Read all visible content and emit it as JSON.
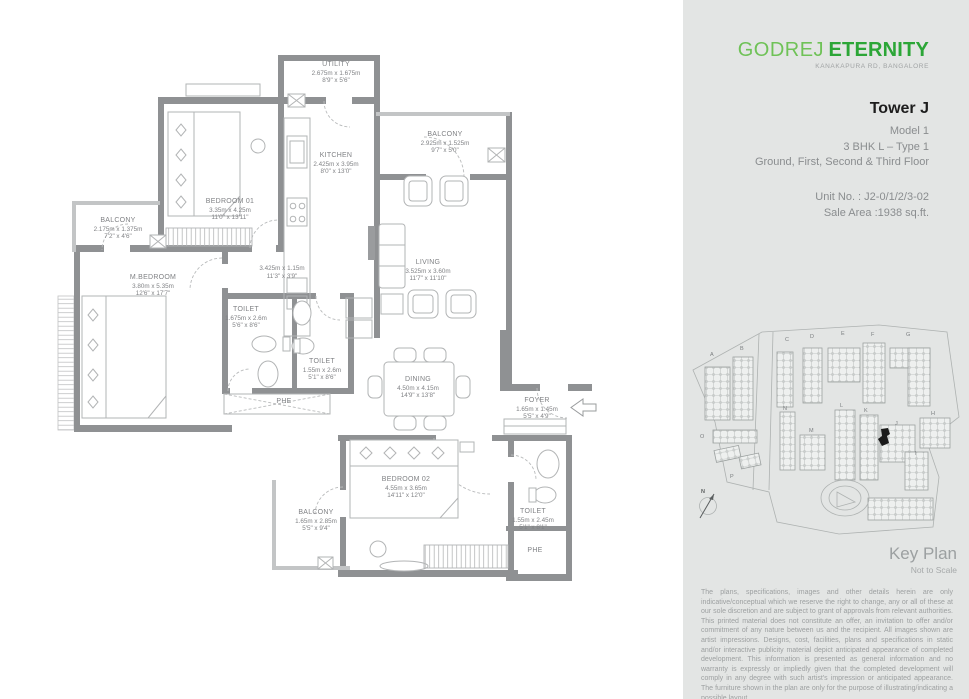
{
  "panel": {
    "brand": {
      "name_light": "GODREJ",
      "name_bold": "ETERNITY",
      "subtitle": "KANAKAPURA RD, BANGALORE"
    },
    "tower_title": "Tower J",
    "model_lines": [
      "Model 1",
      "3 BHK L – Type 1",
      "Ground, First, Second & Third Floor"
    ],
    "unit_no": "Unit No. : J2-0/1/2/3-02",
    "sale_area": "Sale Area :1938 sq.ft.",
    "key_plan": {
      "title": "Key Plan",
      "subtitle": "Not to Scale",
      "highlight_tower": "J",
      "towers": [
        "A",
        "B",
        "C",
        "D",
        "E",
        "F",
        "G",
        "N",
        "M",
        "L",
        "K",
        "J",
        "H",
        "I",
        "O",
        "P"
      ],
      "compass": "N"
    },
    "disclaimer": "The plans, specifications, images and other details herein are only indicative/conceptual which we reserve the right to change, any or all of these at our sole discretion and are subject to grant of approvals from relevant authorities. This printed material does not constitute an offer, an invitation to offer and/or commitment of any nature between us and the recipient. All images shown are artist impressions. Designs, cost, facilities, plans and specifications in static and/or interactive publicity material depict anticipated appearance of completed development. This information is presented as general information and no warranty is expressly or impliedly given that the completed development will comply in any degree with such artist's impression or anticipated appearance. The furniture shown in the plan are only for the purpose of illustrating/indicating a possible layout."
  },
  "plan": {
    "rooms": {
      "utility": {
        "name": "UTILITY",
        "metric": "2.675m x 1.675m",
        "imperial": "8'9\" x 5'6\""
      },
      "balcony_top": {
        "name": "BALCONY",
        "metric": "2.925m x 1.525m",
        "imperial": "9'7\" x 5'0\""
      },
      "kitchen": {
        "name": "KITCHEN",
        "metric": "2.425m x 3.95m",
        "imperial": "8'0\" x 13'0\""
      },
      "bedroom01": {
        "name": "BEDROOM 01",
        "metric": "3.35m x 4.25m",
        "imperial": "11'0\" x 13'11\""
      },
      "balcony_left": {
        "name": "BALCONY",
        "metric": "2.175m x 1.375m",
        "imperial": "7'2\" x 4'6\""
      },
      "mbedroom": {
        "name": "M.BEDROOM",
        "metric": "3.80m x 5.35m",
        "imperial": "12'6\" x 17'7\""
      },
      "passage": {
        "name": "",
        "metric": "3.425m x 1.15m",
        "imperial": "11'3\" x 3'9\""
      },
      "toilet1": {
        "name": "TOILET",
        "metric": "1.675m x 2.6m",
        "imperial": "5'6\" x 8'6\""
      },
      "toilet2": {
        "name": "TOILET",
        "metric": "1.55m x 2.6m",
        "imperial": "5'1\" x 8'6\""
      },
      "living": {
        "name": "LIVING",
        "metric": "3.525m x 3.60m",
        "imperial": "11'7\" x 11'10\""
      },
      "dining": {
        "name": "DINING",
        "metric": "4.50m x 4.15m",
        "imperial": "14'9\" x 13'8\""
      },
      "foyer": {
        "name": "FOYER",
        "metric": "1.65m x 1.45m",
        "imperial": "5'5\" x 4'9\""
      },
      "bedroom02": {
        "name": "BEDROOM 02",
        "metric": "4.55m x 3.65m",
        "imperial": "14'11\" x 12'0\""
      },
      "balcony_bottom": {
        "name": "BALCONY",
        "metric": "1.65m x 2.85m",
        "imperial": "5'5\" x 9'4\""
      },
      "toilet3": {
        "name": "TOILET",
        "metric": "1.55m x 2.45m",
        "imperial": "5'1\" x 8'1\""
      }
    },
    "shafts": {
      "phe": "PHE"
    }
  }
}
